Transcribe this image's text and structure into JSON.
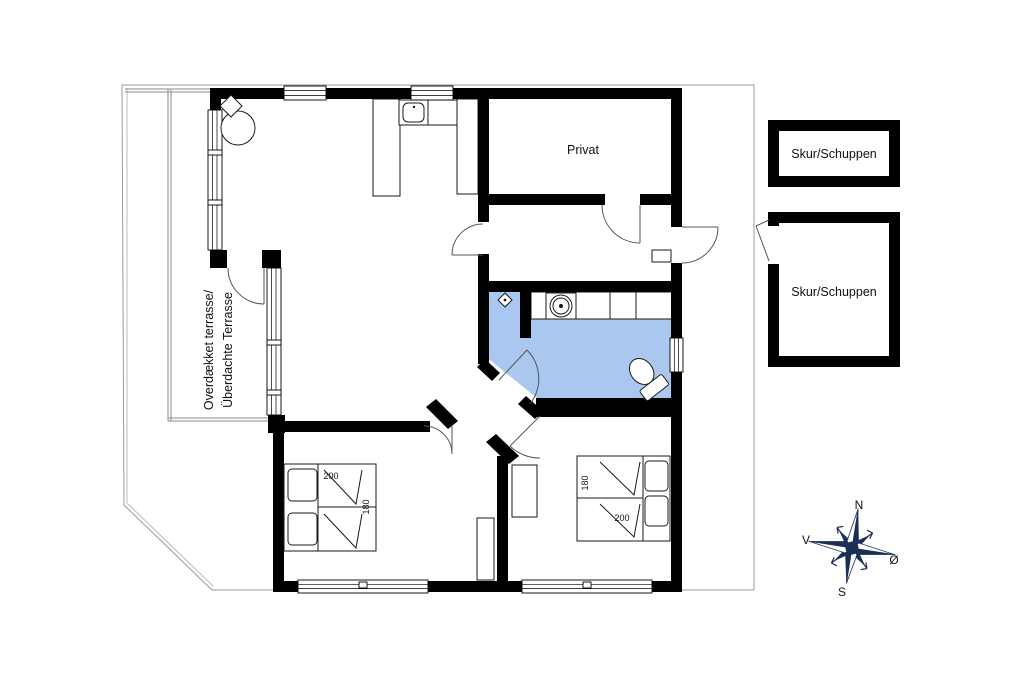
{
  "colors": {
    "wall": "#000000",
    "bath_fill": "#A9C7EF",
    "compass": "#1B2E55",
    "thin_line": "#8a8a8a"
  },
  "rooms": {
    "private_label": "Privat",
    "terrace_label_line1": "Overdækket terrasse/",
    "terrace_label_line2": "Überdachte Terrasse"
  },
  "outbuildings": {
    "shed1_label": "Skur/Schuppen",
    "shed2_label": "Skur/Schuppen"
  },
  "beds": {
    "bed1": {
      "length": "200",
      "width": "180"
    },
    "bed2": {
      "length": "200",
      "width": "180"
    }
  },
  "compass": {
    "north": "N",
    "south": "S",
    "west": "V",
    "east": "Ø"
  }
}
